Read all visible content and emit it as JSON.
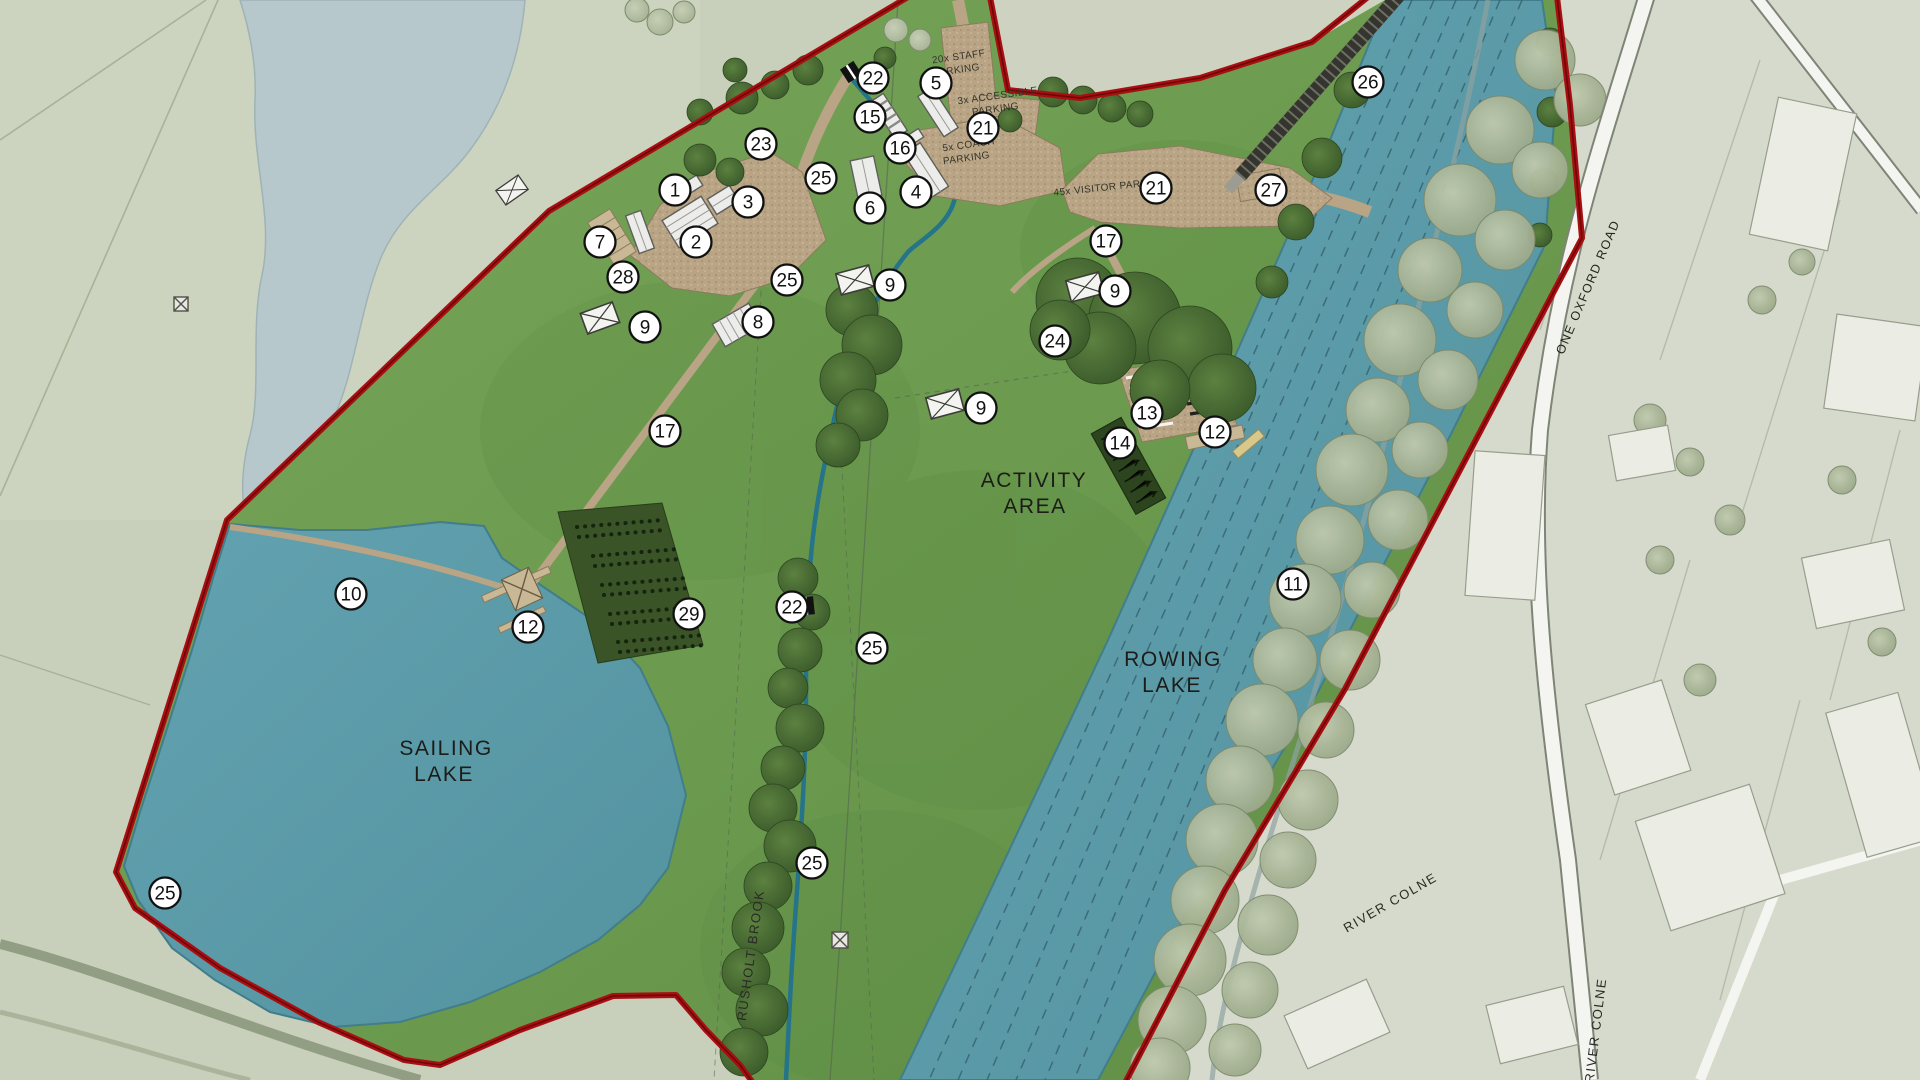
{
  "map": {
    "title": "Watersports park masterplan",
    "labels": {
      "sailing_lake_line1": "SAILING",
      "sailing_lake_line2": "LAKE",
      "rowing_lake_line1": "ROWING",
      "rowing_lake_line2": "LAKE",
      "activity_area_line1": "ACTIVITY",
      "activity_area_line2": "AREA",
      "rusholt_brook": "RUSHOLT BROOK",
      "river_colne_upper": "RIVER COLNE",
      "river_colne_lower": "RIVER COLNE",
      "one_oxford_road": "ONE OXFORD ROAD",
      "staff_parking_line1": "20x STAFF",
      "staff_parking_line2": "PARKING",
      "accessible_parking_line1": "3x ACCESSIBLE",
      "accessible_parking_line2": "PARKING",
      "coach_parking_line1": "5x COACH",
      "coach_parking_line2": "PARKING",
      "visitor_parking": "45x VISITOR PARKING"
    },
    "colors": {
      "site_green": "#6f9b50",
      "water_blue": "#5e9fae",
      "boundary_red": "#a90f12",
      "offsite_left": "#c8d0bb",
      "offsite_right": "#d6dacc",
      "path_tan": "#b9a585",
      "tree_dark": "#46662f",
      "planting_dark": "#3a5427"
    },
    "icons": [
      "gate-icon",
      "bridge-icon",
      "shelter-icon",
      "pylon-icon",
      "jetty-icon",
      "grandstand-icon",
      "railway-icon"
    ],
    "markers": [
      {
        "n": "1",
        "x": 675,
        "y": 190
      },
      {
        "n": "2",
        "x": 696,
        "y": 242
      },
      {
        "n": "3",
        "x": 748,
        "y": 202
      },
      {
        "n": "4",
        "x": 916,
        "y": 192
      },
      {
        "n": "5",
        "x": 936,
        "y": 83
      },
      {
        "n": "6",
        "x": 870,
        "y": 208
      },
      {
        "n": "7",
        "x": 600,
        "y": 242
      },
      {
        "n": "8",
        "x": 758,
        "y": 322
      },
      {
        "n": "9",
        "x": 645,
        "y": 327
      },
      {
        "n": "9",
        "x": 890,
        "y": 285
      },
      {
        "n": "9",
        "x": 1115,
        "y": 291
      },
      {
        "n": "9",
        "x": 981,
        "y": 408
      },
      {
        "n": "10",
        "x": 351,
        "y": 594
      },
      {
        "n": "11",
        "x": 1293,
        "y": 584
      },
      {
        "n": "12",
        "x": 528,
        "y": 627
      },
      {
        "n": "12",
        "x": 1215,
        "y": 432
      },
      {
        "n": "13",
        "x": 1147,
        "y": 413
      },
      {
        "n": "14",
        "x": 1120,
        "y": 443
      },
      {
        "n": "15",
        "x": 870,
        "y": 117
      },
      {
        "n": "16",
        "x": 900,
        "y": 148
      },
      {
        "n": "17",
        "x": 1106,
        "y": 241
      },
      {
        "n": "17",
        "x": 665,
        "y": 431
      },
      {
        "n": "21",
        "x": 983,
        "y": 128
      },
      {
        "n": "21",
        "x": 1156,
        "y": 188
      },
      {
        "n": "22",
        "x": 873,
        "y": 78
      },
      {
        "n": "22",
        "x": 792,
        "y": 607
      },
      {
        "n": "23",
        "x": 761,
        "y": 144
      },
      {
        "n": "24",
        "x": 1055,
        "y": 341
      },
      {
        "n": "25",
        "x": 821,
        "y": 178
      },
      {
        "n": "25",
        "x": 787,
        "y": 280
      },
      {
        "n": "25",
        "x": 872,
        "y": 648
      },
      {
        "n": "25",
        "x": 812,
        "y": 863
      },
      {
        "n": "25",
        "x": 165,
        "y": 893
      },
      {
        "n": "26",
        "x": 1368,
        "y": 82
      },
      {
        "n": "27",
        "x": 1271,
        "y": 190
      },
      {
        "n": "28",
        "x": 623,
        "y": 277
      },
      {
        "n": "29",
        "x": 689,
        "y": 614
      }
    ]
  }
}
